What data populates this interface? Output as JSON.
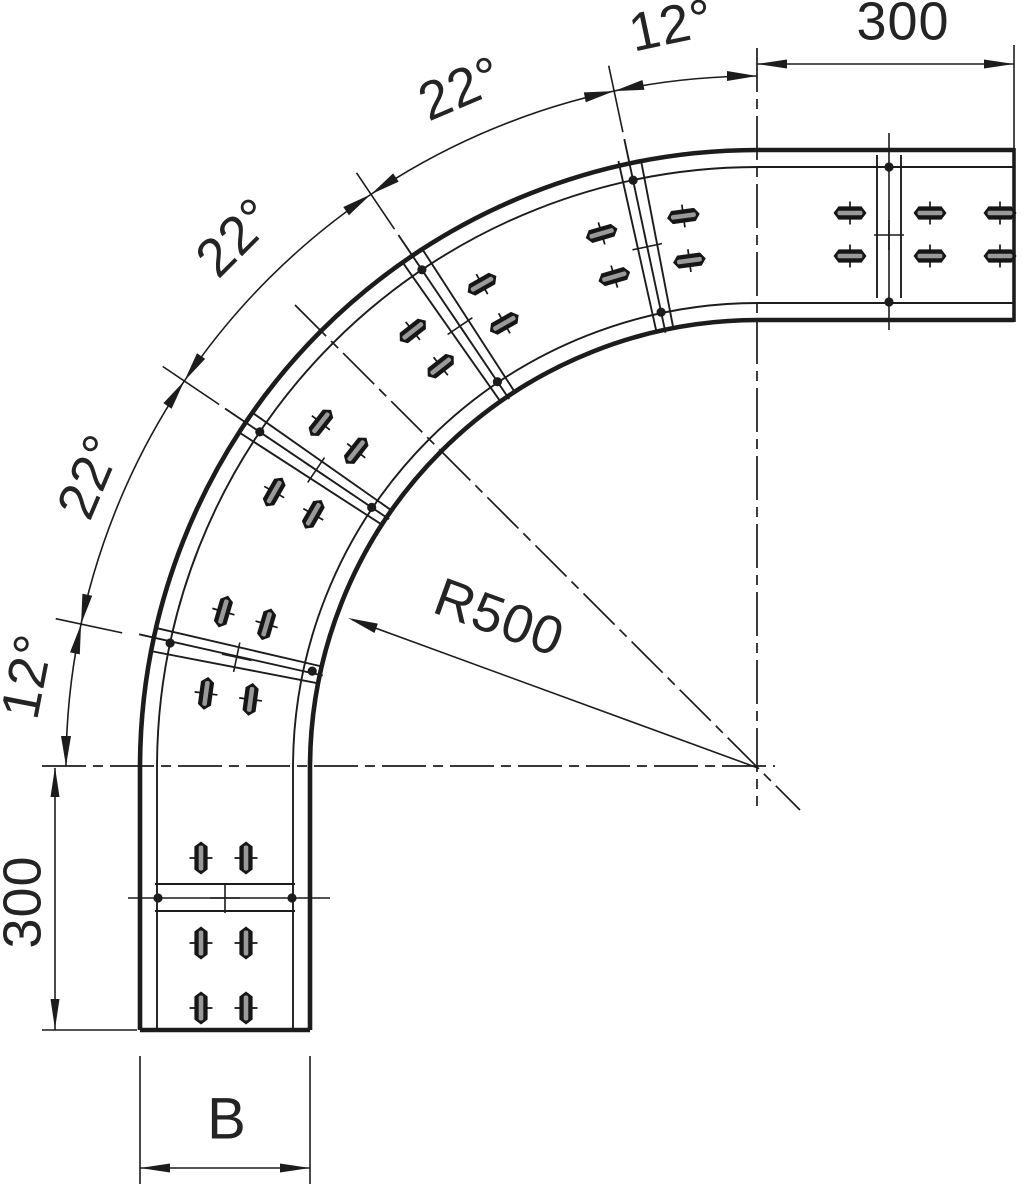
{
  "drawing": {
    "title": "90-degree cable tray bend, segmented (plan view)",
    "labels": {
      "angle_1": "12°",
      "angle_2": "22°",
      "angle_3": "22°",
      "angle_4": "22°",
      "angle_5": "12°",
      "dim_top": "300",
      "dim_left": "300",
      "radius": "R500",
      "width": "B"
    },
    "segment_angles_deg": [
      12,
      22,
      22,
      22,
      12
    ],
    "leg_length_mm": 300,
    "bend_radius_label": "R500"
  }
}
